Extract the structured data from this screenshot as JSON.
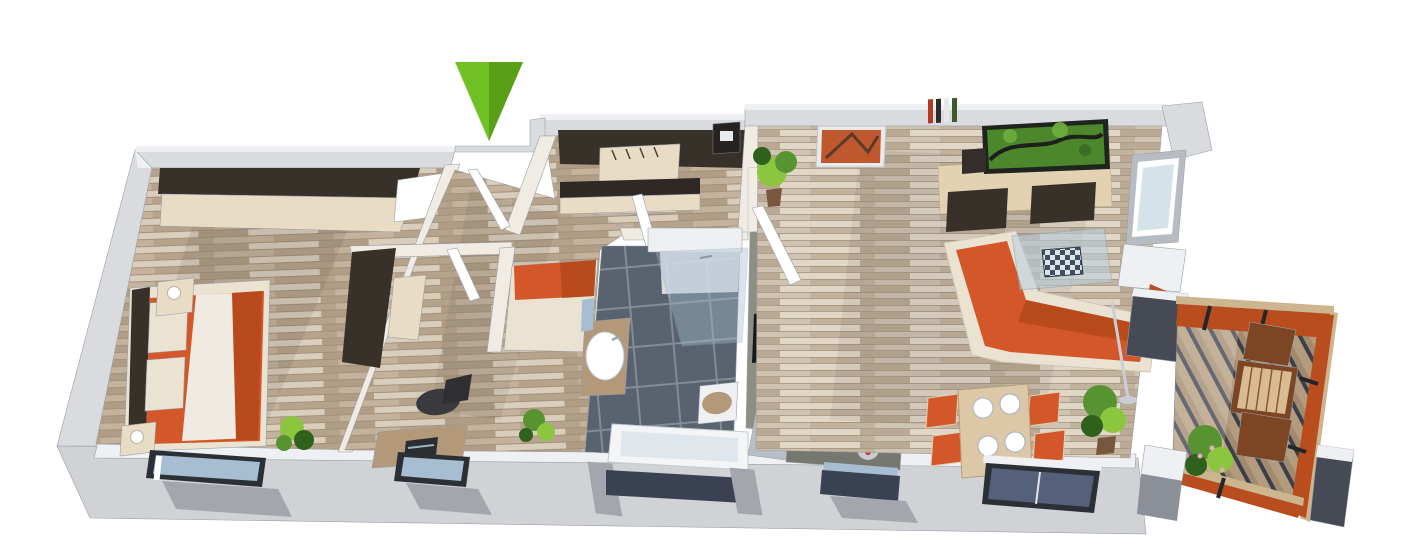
{
  "scene": {
    "description": "3D isometric rendering of an apartment floor plan, no text labels",
    "background": "#ffffff"
  },
  "entrance_marker": {
    "icon": "arrow-down-icon",
    "color": "#70c026",
    "shade_color": "#569c15"
  },
  "colors": {
    "wall_gray": "#d9dbdf",
    "wall_face": "#eef0f3",
    "wall_dark": "#b7bbc2",
    "wall_bottom": "#d0d2d6",
    "wall_inner": "#f1ece3",
    "floor_wood": "#c4b29c",
    "floor_wood_light": "#d9cdbb",
    "floor_wood_dark": "#aa9780",
    "floor_living": "#cfc3b1",
    "floor_living_light": "#e1d7c7",
    "floor_living_dark": "#b5a48e",
    "dark_furniture": "#38312a",
    "beige_cabinet": "#e9dcc5",
    "wood_mid": "#b3987a",
    "orange": "#d4572a",
    "orange_deep": "#b94a1c",
    "cream": "#ebe3d2",
    "duvet": "#f0ebe2",
    "tile_dark": "#59626f",
    "tile_grout": "#828b97",
    "tile_white": "#eef0f2",
    "glass_blue": "#a7bed2",
    "window_sky": "#d6e2ea",
    "window_navy": "#3a4152",
    "frame_dark": "#2b2f36",
    "stone": "#a3a7ad",
    "counter": "#8d8f85",
    "counter_dark": "#767870",
    "steel": "#b6bfc7",
    "black": "#17181b",
    "chrome": "#c9ced4",
    "plant": "#579431",
    "plant_dark": "#2f611c",
    "plant_light": "#8cc63f",
    "pot": "#77573e",
    "tv_green": "#4c872c",
    "tv_dark": "#20241e",
    "art_orange": "#c0582e",
    "deck": "#a28a6e",
    "deck_gap": "#3b3f47",
    "terrace_glass": "#ba4d1e",
    "terrace_wood": "#7c4523",
    "rail_wood": "#cdb58f",
    "slate": "#454a55",
    "arrow_green": "#70c026",
    "arrow_green_dark": "#569c15"
  }
}
